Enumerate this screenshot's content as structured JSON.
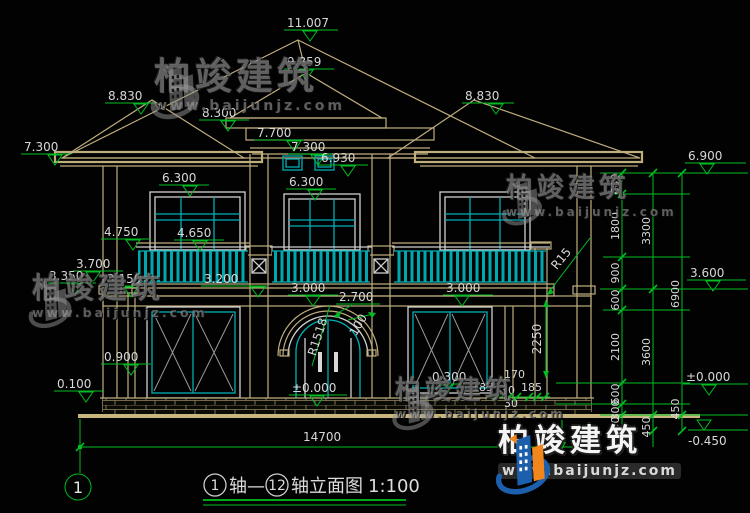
{
  "watermark": {
    "brand": "柏竣建筑",
    "url": "www.baijunjz.com"
  },
  "axis": {
    "bubble": "1"
  },
  "title": {
    "axis_start": "1",
    "axis_start_suffix": "轴—",
    "axis_end": "12",
    "axis_end_suffix": "轴立面图",
    "scale": "1:100"
  },
  "levels": {
    "ridge": "11.007",
    "gable": "9.859",
    "wing_left": "8.830",
    "wing_right": "8.830",
    "dormer_eave": "8.300",
    "dormer_top": "7.700",
    "eave_left": "7.300",
    "dormer_mid": "7.300",
    "vent": "6.930",
    "win_left": "6.300",
    "win_center": "6.300",
    "eave_right": "6.900",
    "rail_outer": "4.750",
    "rail_inner": "4.650",
    "band_3700": "3.700",
    "band_3350": "3.350",
    "band_3150": "3.150",
    "band_3200": "3.200",
    "slab_center": "3.000",
    "slab_right": "3.000",
    "arch": "2.700",
    "floor_3600": "3.600",
    "ledge_0900": "0.900",
    "plinth_0100": "0.100",
    "zero_door": "±0.000",
    "sill_right": "0.300",
    "zero_right": "±0.000",
    "below_grade": "-0.450"
  },
  "dims": {
    "total_width": "14700",
    "arch_radius": "R1518",
    "arch_note": "100",
    "balcony_radius": "R15",
    "window_h": "2250",
    "pier_170": "170",
    "pier_185a": "185",
    "pier_30a": "30",
    "pier_185b": "185",
    "pier_30b": "30",
    "chain_inner": [
      "600",
      "1800",
      "900",
      "600",
      "2100",
      "600",
      "300",
      "450"
    ],
    "chain_mid": [
      "3300",
      "3600",
      "450"
    ],
    "chain_outer": [
      "6900",
      "450"
    ]
  },
  "colors": {
    "dimension_green": "#00bd22",
    "linework_tan": "#bfae7e",
    "glazing_cyan": "#00b0b6",
    "brand_blue": "#1c5fad",
    "brand_orange": "#f1871c"
  }
}
